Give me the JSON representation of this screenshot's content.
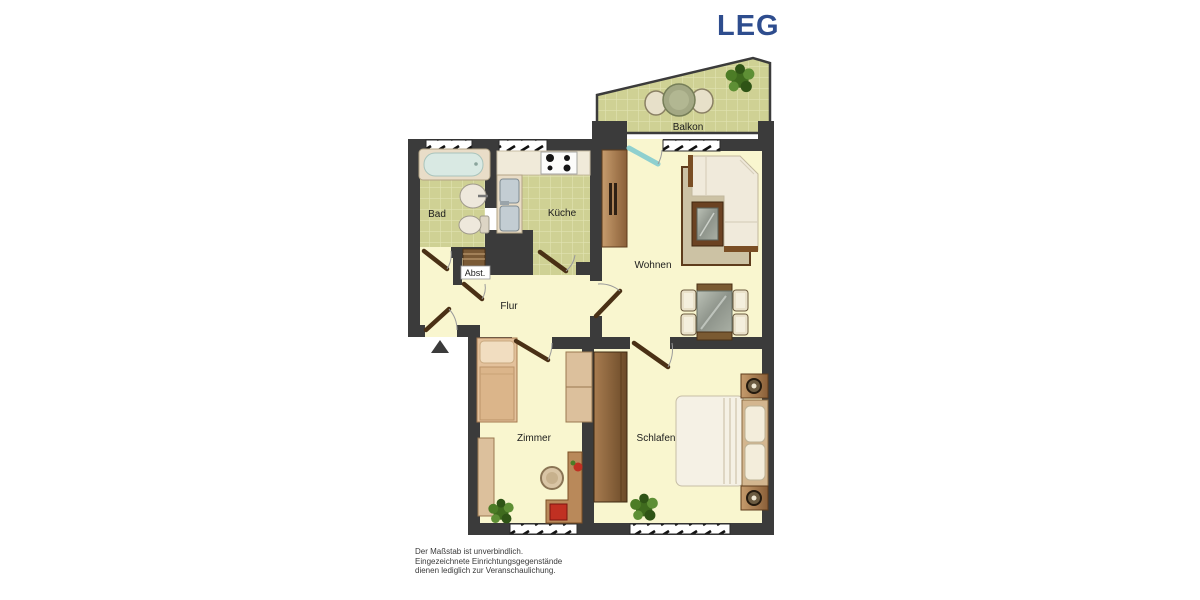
{
  "logo": {
    "text": "LEG"
  },
  "rooms": {
    "balkon": "Balkon",
    "bad": "Bad",
    "kueche": "Küche",
    "wohnen": "Wohnen",
    "abst": "Abst.",
    "flur": "Flur",
    "zimmer": "Zimmer",
    "schlafen": "Schlafen"
  },
  "disclaimer": {
    "line1": "Der Maßstab ist unverbindlich.",
    "line2": "Eingezeichnete Einrichtungsgegenstände",
    "line3": "dienen lediglich zur Veranschaulichung."
  },
  "colors": {
    "brand": "#2e4d8e",
    "wall": "#3b3b3b",
    "floor": "#f9f6cf",
    "tile": "#cfd194",
    "grout": "#e1e3b2",
    "label": "#1c1c1c",
    "door": "#4a3015",
    "balcony-door": "#8fd0cf",
    "plant": "#4c7c26",
    "accent-red": "#c03022",
    "disclaimer": "#3a3a3a"
  }
}
